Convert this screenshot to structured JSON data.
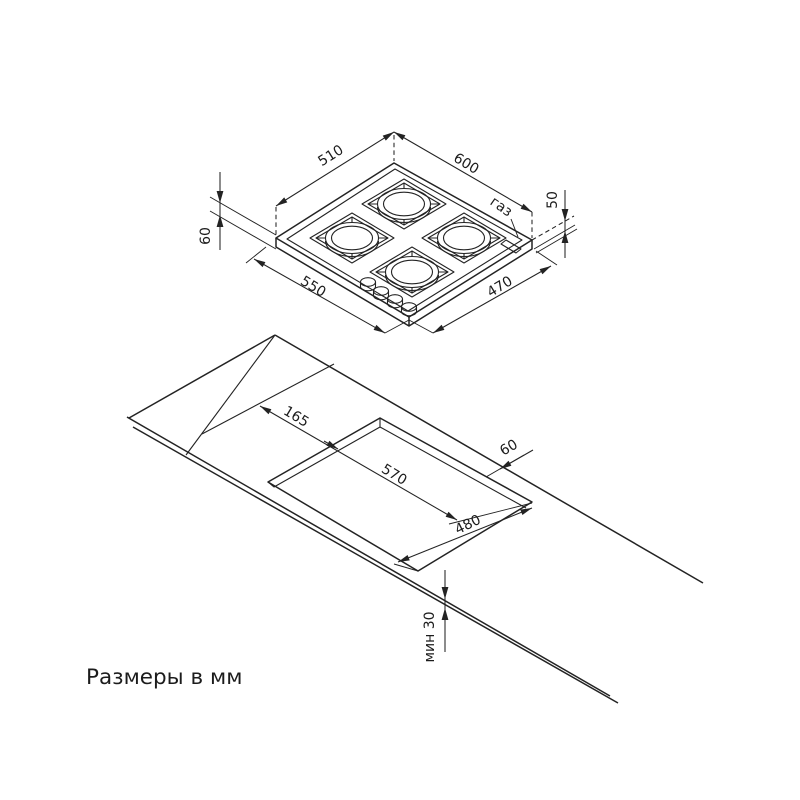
{
  "colors": {
    "background": "#ffffff",
    "ink": "#232323"
  },
  "caption": "Размеры в мм",
  "hob_view": {
    "dims": {
      "top_left_edge": "510",
      "top_right_edge": "600",
      "bottom_left_edge": "550",
      "bottom_right_edge": "470",
      "height_left": "60",
      "height_right": "50"
    },
    "gas_label": "газ"
  },
  "cutout_view": {
    "dims": {
      "rear_offset": "165",
      "side_offset": "60",
      "cutout_width": "570",
      "cutout_depth": "480",
      "front_min": "мин 30"
    }
  }
}
